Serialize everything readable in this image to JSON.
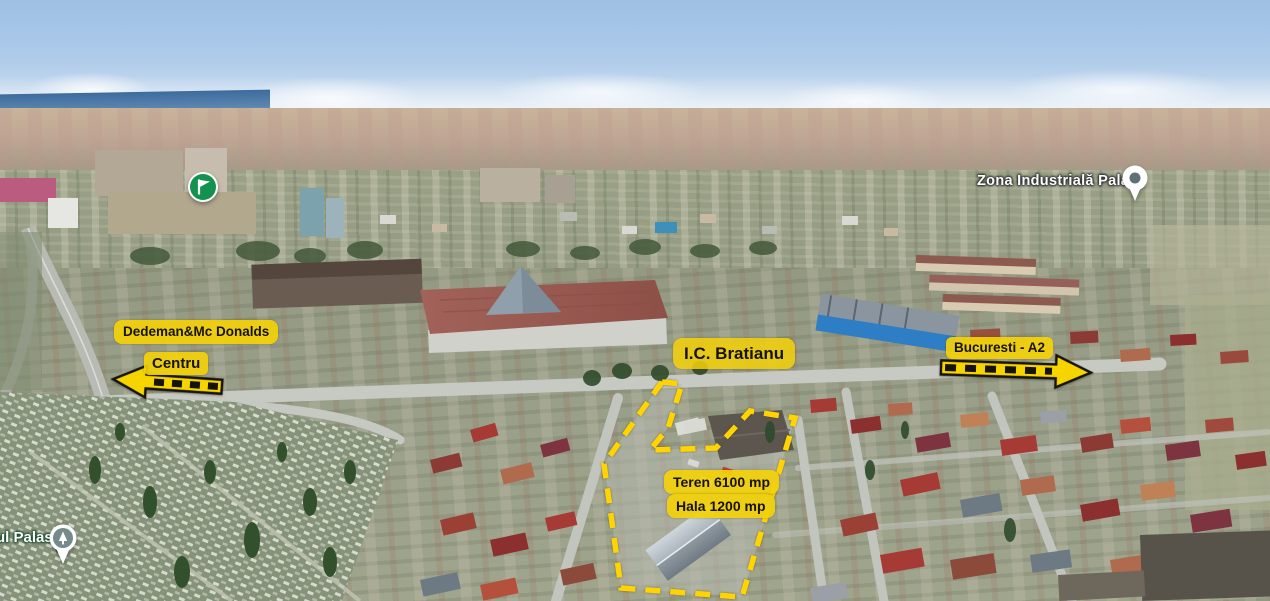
{
  "map": {
    "view": "3D aerial",
    "markers": {
      "flag": {
        "icon": "flag-icon"
      },
      "zona_palas": {
        "label": "Zona Industrială Palas",
        "icon": "place-pin-icon"
      },
      "cemetery_palas": {
        "label": "ul Palas",
        "icon": "cemetery-pin-icon"
      }
    },
    "annotations": {
      "dedeman": {
        "label": "Dedeman&Mc Donalds"
      },
      "centru": {
        "label": "Centru",
        "arrow_direction": "left"
      },
      "ic_bratianu": {
        "label": "I.C. Bratianu"
      },
      "bucuresti_a2": {
        "label": "Bucuresti - A2",
        "arrow_direction": "right"
      },
      "teren": {
        "label": "Teren 6100 mp"
      },
      "hala": {
        "label": "Hala 1200 mp"
      },
      "property_outline_style": "yellow-dashed"
    },
    "colors": {
      "annotation_yellow": "#F3D109",
      "annotation_text": "#161309",
      "dash_yellow": "#FFD400",
      "arrow_yellow": "#F6D400",
      "flag_green": "#12914F",
      "map_label_white": "#FFFFFF",
      "pin_inner_gray": "#5F7077",
      "cemetery_pin_inner": "#76898B"
    }
  }
}
